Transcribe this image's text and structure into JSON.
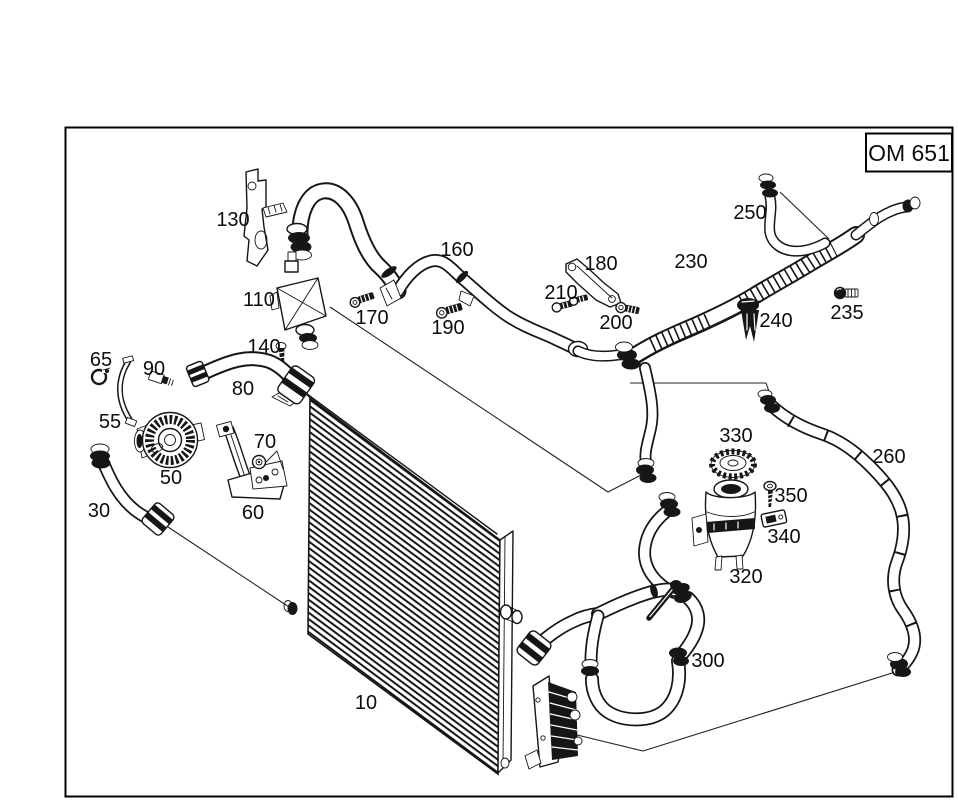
{
  "diagram": {
    "engine_code_box": "OM 651",
    "part_labels": {
      "p10": "10",
      "p30": "30",
      "p50": "50",
      "p55": "55",
      "p60": "60",
      "p65": "65",
      "p70": "70",
      "p80": "80",
      "p90": "90",
      "p110": "110",
      "p130": "130",
      "p140": "140",
      "p160": "160",
      "p170": "170",
      "p180": "180",
      "p190": "190",
      "p200": "200",
      "p210": "210",
      "p230": "230",
      "p235": "235",
      "p240": "240",
      "p250": "250",
      "p260": "260",
      "p300": "300",
      "p320": "320",
      "p330": "330",
      "p340": "340",
      "p350": "350"
    }
  }
}
